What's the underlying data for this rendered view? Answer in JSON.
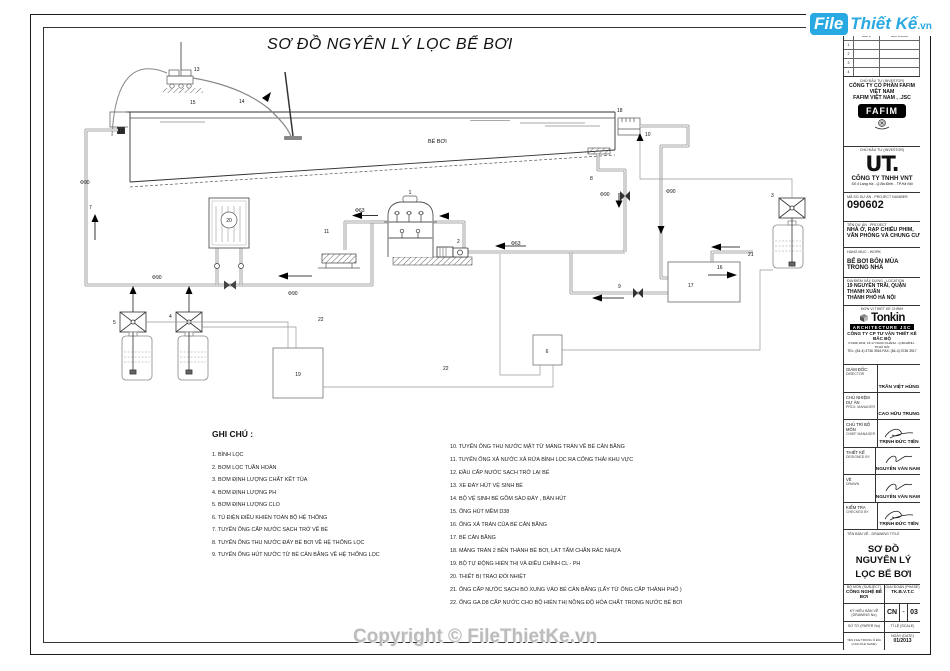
{
  "logo": {
    "file": "File",
    "brand": "Thiết Kế",
    "domain": ".vn"
  },
  "copyright": "Copyright © FileThietKe.vn",
  "drawing": {
    "title": "SƠ ĐỒ NGYÊN LÝ LỌC BỂ BƠI",
    "labels": {
      "pool": "BỂ BƠI",
      "phi90": "Φ90",
      "phi63": "Φ63"
    },
    "callouts": [
      "1",
      "2",
      "3",
      "4",
      "5",
      "6",
      "7",
      "8",
      "9",
      "10",
      "11",
      "12",
      "13",
      "14",
      "15",
      "16",
      "17",
      "18",
      "19",
      "20",
      "21",
      "22"
    ]
  },
  "legend": {
    "heading": "GHI CHÚ :",
    "items_left": [
      "1. BÌNH LỌC",
      "2. BƠM LỌC TUẦN HOÀN",
      "3. BƠM ĐỊNH LƯỢNG CHẤT KẾT TỦA",
      "4. BƠM ĐỊNH LƯỢNG PH",
      "5. BƠM  ĐỊNH LƯỢNG CLO",
      "6. TỦ ĐIỆN ĐIỀU KHIỂN TOÀN BỘ HỆ THỐNG",
      "7. TUYẾN ỐNG CẤP NƯỚC SẠCH TRỞ VỀ BỂ",
      "8. TUYẾN ỐNG THU NƯỚC ĐÁY BỂ BƠI VỀ HỆ THỐNG LỌC",
      "9. TUYẾN ỐNG HÚT NƯỚC TỪ BỂ CÂN BẰNG VỀ HỆ THỐNG LỌC"
    ],
    "items_right": [
      "10. TUYẾN ỐNG THU NƯỚC MẶT TỪ  MÁNG TRÀN VỀ BỂ CÂN BẰNG",
      "11. TUYẾN ỐNG XẢ NƯỚC XẢ RỬA BÌNH LỌC RA CỐNG THẢI KHU VỰC",
      "12. ĐẦU CẤP NƯỚC SẠCH TRỞ LẠI BỂ",
      "13. XE ĐẨY HÚT VỆ SINH BỂ",
      "14. BỘ VỆ SINH BỂ GỒM SÀO ĐẨY , BÀN HÚT",
      "15. ỐNG HÚT MỀM D38",
      "16. ỐNG XẢ TRÀN CỦA BỂ CÂN BẰNG",
      "17. BỂ CÂN BẰNG",
      "18. MÁNG TRÀN 2 BÊN THÀNH BỂ BƠI, LÁT TẤM CHẮN RÁC NHỰA",
      "19. BỘ TỰ ĐỘNG HIỂN THỊ VÀ ĐIỀU CHỈNH CL - PH",
      "20. THIẾT BỊ TRAO ĐỔI NHIỆT",
      "21. ỐNG CẤP NƯỚC SẠCH BỔ XUNG VÀO BỂ CÂN BẰNG (LẤY TỪ ỐNG CẤP THÀNH PHỐ )",
      "22. ỐNG GA D8 CẤP NƯỚC CHO BỘ HIỂN THỊ NỒNG ĐỘ HÓA CHẤT TRONG NƯỚC BỂ BƠI"
    ]
  },
  "titleblock": {
    "revisions": {
      "col_date": "DATE",
      "col_note": "NỘI DUNG",
      "rows": [
        "1",
        "2",
        "3",
        "4"
      ]
    },
    "investor_label": "CHỦ ĐẦU TƯ (INVESTOR)",
    "investor1": {
      "name1": "CÔNG TY CỔ PHẦN FAFIM VIỆT NAM",
      "name2": "FAFIM VIỆT NAM , .JSC",
      "logo": "FAFIM"
    },
    "investor2": {
      "logo_glyph": "UT.",
      "name": "CÔNG TY TNHH VNT",
      "address": "Số 4 Láng Hạ - Q.Ba Đình - TP.Hà Nội"
    },
    "project_number": {
      "label": "MÃ SỐ DỰ ÁN - PROJECT NUMBER",
      "value": "090602"
    },
    "project": {
      "label": "TÊN DỰ ÁN - PROJECT",
      "line1": "NHÀ Ở, RẠP CHIẾU PHIM,",
      "line2": "VĂN PHÒNG VÀ CHUNG CƯ"
    },
    "work": {
      "label": "HẠNG MỤC - WORK",
      "value": "BỂ BƠI BỐN MÙA TRONG NHÀ"
    },
    "location": {
      "label": "ĐỊA ĐIỂM XÂY DỰNG - LOCATION",
      "line1": "19 NGUYỄN TRÃI, QUẬN THANH XUÂN",
      "line2": "THÀNH PHỐ HÀ NỘI"
    },
    "design_firm": {
      "label": "ĐƠN VỊ THIẾT KẾ CHÍNH",
      "logo": "Tonkin",
      "logo_sub": "ARCHITECTURE JSC",
      "name": "CÔNG TY CP TƯ VẤN THIẾT KẾ BẮC BỘ",
      "address": "P.1208, ĐN2, 15-17 NGỌC KHÁNH - Q.BA ĐÌNH - TP.HÀ NỘI",
      "tel": "TEL: (84-4) 3736 3916  FAX: (84-4) 3736 3917"
    },
    "staff": [
      {
        "vn": "GIÁM ĐỐC:",
        "en": "DIRECTOR",
        "name": "TRẦN VIỆT HÙNG"
      },
      {
        "vn": "CHỦ NHIỆM DỰ ÁN",
        "en": "PROJ. MANAGER",
        "name": "CAO HỮU TRUNG"
      },
      {
        "vn": "CHỦ TRÌ BỘ MÔN",
        "en": "CHIEF MANAGER",
        "name": "TRỊNH ĐỨC TIẾN"
      },
      {
        "vn": "THIẾT KẾ",
        "en": "DESIGNED BY",
        "name": "NGUYỄN VĂN NAM"
      },
      {
        "vn": "VẼ",
        "en": "DRAWN",
        "name": "NGUYỄN VĂN NAM"
      },
      {
        "vn": "KIỂM TRA",
        "en": "CHECKED BY",
        "name": "TRỊNH ĐỨC TIẾN"
      }
    ],
    "drawing_title": {
      "label": "TÊN BẢN VẼ - DRAWING TITLE",
      "line1": "SƠ ĐỒ NGUYÊN LÝ",
      "line2": "LỌC BỂ BƠI"
    },
    "meta": {
      "subject_label": "BỘ MÔN (SUBJECT)",
      "subject": "CÔNG NGHỆ BỂ BƠI",
      "phase_label": "GIAI ĐOẠN (PHASE)",
      "phase": "TK.B.V.T.C",
      "drawno_label": "KÝ HIỆU BẢN VẼ (DRAWING No)",
      "drawno_left": "CN",
      "drawno_mid": "-",
      "drawno_right": "03",
      "paper_label": "SỐ TỜ (PAPER No)",
      "scale_label": "TỈ LỆ (SCALE)",
      "file_label": "TÊN FILE TRONG Ổ ĐĨA (CAD FILE NAME)",
      "date_label": "NGÀY (DATE)",
      "date": "01/2013"
    }
  }
}
